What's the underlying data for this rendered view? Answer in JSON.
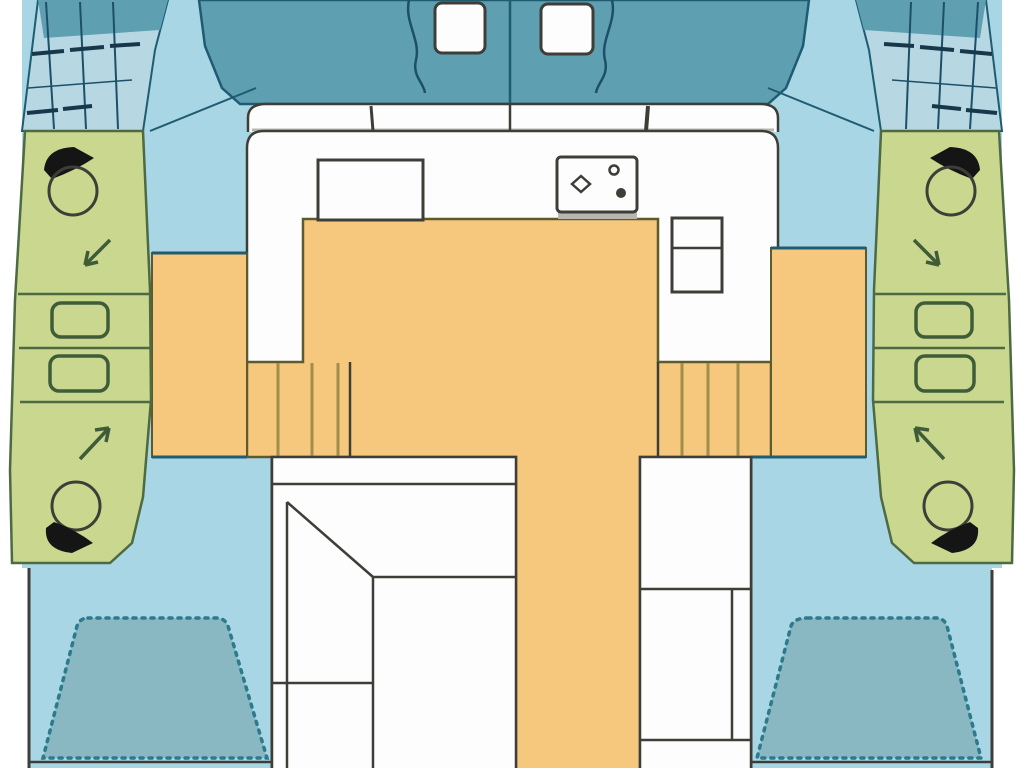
{
  "meta": {
    "title": "catamaran-deck-floorplan",
    "width": 1024,
    "height": 768
  },
  "colors": {
    "page": "#ffffff",
    "deck": "#a9d6e5",
    "hull": "#5f9fb2",
    "net": "#b7d8e3",
    "netline": "#1d5068",
    "tealline": "#1f5c72",
    "beddark": "#16384a",
    "bedfill": "#8ab8c2",
    "bedstroke": "#2d7a8c",
    "green": "#c9d88e",
    "greenline": "#4e6a43",
    "sinkline": "#3f5c39",
    "orange": "#f6c87e",
    "olive": "#5d5a2e",
    "step": "#a08e4a",
    "white": "#fdfdfd",
    "dark": "#3e3e38",
    "black": "#151515",
    "gray": "#b9b6b0"
  },
  "shapes": [
    {
      "n": "deck",
      "k": "polygon",
      "p": "22,0 1002,0 1002,568 992,568 992,772 29,772 29,568 22,568",
      "f": "deck"
    },
    {
      "n": "bow-left-net-area",
      "k": "polygon",
      "p": "38,0 168,0 155,50 143,131 22,131",
      "f": "net",
      "s": "tealline",
      "sw": 2
    },
    {
      "n": "bow-left-cap",
      "k": "polygon",
      "p": "38,0 168,0 160,30 44,38",
      "f": "hull"
    },
    {
      "n": "bow-left-net-line-1",
      "k": "line",
      "x1": 46,
      "y1": 2,
      "x2": 54,
      "y2": 129,
      "s": "netline",
      "sw": 2
    },
    {
      "n": "bow-left-net-line-2",
      "k": "line",
      "x1": 80,
      "y1": 2,
      "x2": 86,
      "y2": 129,
      "s": "netline",
      "sw": 2
    },
    {
      "n": "bow-left-net-line-3",
      "k": "line",
      "x1": 113,
      "y1": 2,
      "x2": 118,
      "y2": 129,
      "s": "netline",
      "sw": 2
    },
    {
      "n": "bow-left-net-line-4",
      "k": "line",
      "x1": 28,
      "y1": 88,
      "x2": 132,
      "y2": 80,
      "s": "netline",
      "sw": 1.5
    },
    {
      "n": "bow-left-windlass",
      "k": "path",
      "d": "M32,54 L64,51 M70,50 L104,47 M110,46 L140,44 M27,113 L58,110 M63,109 L92,106",
      "s": "beddark",
      "sw": 4
    },
    {
      "n": "bow-right-net-area",
      "k": "polygon",
      "p": "986,0 856,0 869,50 881,131 1002,131",
      "f": "net",
      "s": "tealline",
      "sw": 2
    },
    {
      "n": "bow-right-cap",
      "k": "polygon",
      "p": "986,0 856,0 864,30 980,38",
      "f": "hull"
    },
    {
      "n": "bow-right-net-line-1",
      "k": "line",
      "x1": 978,
      "y1": 2,
      "x2": 970,
      "y2": 129,
      "s": "netline",
      "sw": 2
    },
    {
      "n": "bow-right-net-line-2",
      "k": "line",
      "x1": 944,
      "y1": 2,
      "x2": 938,
      "y2": 129,
      "s": "netline",
      "sw": 2
    },
    {
      "n": "bow-right-net-line-3",
      "k": "line",
      "x1": 911,
      "y1": 2,
      "x2": 906,
      "y2": 129,
      "s": "netline",
      "sw": 2
    },
    {
      "n": "bow-right-net-line-4",
      "k": "line",
      "x1": 996,
      "y1": 88,
      "x2": 892,
      "y2": 80,
      "s": "netline",
      "sw": 1.5
    },
    {
      "n": "bow-right-windlass",
      "k": "path",
      "d": "M992,54 L960,51 M954,50 L920,47 M914,46 L884,44 M997,113 L966,110 M961,109 L932,106",
      "s": "beddark",
      "sw": 4
    },
    {
      "n": "forward-cockpit",
      "k": "polygon",
      "p": "199,0 809,0 803,46 786,88 768,104 240,104 222,88 205,46",
      "f": "hull",
      "s": "tealline",
      "sw": 2.5
    },
    {
      "n": "cockpit-center-line",
      "k": "line",
      "x1": 510,
      "y1": 0,
      "x2": 510,
      "y2": 104,
      "s": "tealline",
      "sw": 2.5
    },
    {
      "n": "rope-left",
      "k": "path",
      "d": "M409,0 C404,22 421,40 416,60 C412,76 424,83 425,93",
      "s": "netline",
      "sw": 2.5
    },
    {
      "n": "rope-right",
      "k": "path",
      "d": "M612,0 C617,22 600,40 605,60 C609,76 597,83 596,93",
      "s": "netline",
      "sw": 2.5
    },
    {
      "n": "hatch-left",
      "k": "rect",
      "x": 435,
      "y": 3,
      "w": 50,
      "h": 50,
      "rx": 7,
      "f": "white",
      "s": "dark",
      "sw": 3
    },
    {
      "n": "hatch-right",
      "k": "rect",
      "x": 541,
      "y": 4,
      "w": 52,
      "h": 50,
      "rx": 7,
      "f": "white",
      "s": "dark",
      "sw": 3
    },
    {
      "n": "deck-seam-left",
      "k": "line",
      "x1": 256,
      "y1": 88,
      "x2": 150,
      "y2": 131,
      "s": "tealline",
      "sw": 2
    },
    {
      "n": "deck-seam-right",
      "k": "line",
      "x1": 768,
      "y1": 88,
      "x2": 874,
      "y2": 131,
      "s": "tealline",
      "sw": 2
    },
    {
      "n": "coachroof-band",
      "k": "path",
      "d": "M248,132 L248,118 Q248,104 266,104 L760,104 Q778,104 778,118 L778,132",
      "f": "white",
      "s": "dark",
      "sw": 2.5
    },
    {
      "n": "coachroof-band-shadow",
      "k": "line",
      "x1": 252,
      "y1": 130,
      "x2": 774,
      "y2": 130,
      "s": "gray",
      "sw": 3
    },
    {
      "n": "band-tick-left",
      "k": "line",
      "x1": 371,
      "y1": 106,
      "x2": 373,
      "y2": 131,
      "s": "dark",
      "sw": 3
    },
    {
      "n": "band-tick-center",
      "k": "line",
      "x1": 510,
      "y1": 104,
      "x2": 510,
      "y2": 131,
      "s": "dark",
      "sw": 2.5
    },
    {
      "n": "band-tick-right",
      "k": "line",
      "x1": 648,
      "y1": 106,
      "x2": 646,
      "y2": 131,
      "s": "dark",
      "sw": 4
    },
    {
      "n": "cabin-body",
      "k": "path",
      "d": "M247,457 L247,148 Q247,131 264,131 L761,131 Q778,131 778,148 L778,457",
      "f": "white",
      "s": "dark",
      "sw": 2.5
    },
    {
      "n": "salon-floor",
      "k": "polygon",
      "p": "303,219 658,219 658,362 771,362 771,457 640,457 640,772 516,772 516,457 247,457 247,362 303,362",
      "f": "orange",
      "s": "olive",
      "sw": 2.5
    },
    {
      "n": "hull-corridor-left",
      "k": "rect",
      "x": 152,
      "y": 253,
      "w": 95,
      "h": 204,
      "f": "orange",
      "s": "olive",
      "sw": 2
    },
    {
      "n": "hull-corridor-right",
      "k": "rect",
      "x": 771,
      "y": 248,
      "w": 95,
      "h": 209,
      "f": "orange",
      "s": "olive",
      "sw": 2
    },
    {
      "n": "corridor-edge-left",
      "k": "line",
      "x1": 152,
      "y1": 253,
      "x2": 247,
      "y2": 253,
      "s": "tealline",
      "sw": 3
    },
    {
      "n": "corridor-edge-right",
      "k": "line",
      "x1": 771,
      "y1": 248,
      "x2": 866,
      "y2": 248,
      "s": "tealline",
      "sw": 3
    },
    {
      "n": "steps-left",
      "k": "path",
      "d": "M278,363 L278,456 M312,363 L312,456 M338,363 L338,456",
      "s": "step",
      "sw": 3
    },
    {
      "n": "steps-left-edge",
      "k": "line",
      "x1": 350,
      "y1": 362,
      "x2": 350,
      "y2": 457,
      "s": "dark",
      "sw": 2.5
    },
    {
      "n": "steps-right",
      "k": "path",
      "d": "M682,363 L682,456 M708,363 L708,456 M738,363 L738,456",
      "s": "step",
      "sw": 3
    },
    {
      "n": "steps-right-edge",
      "k": "line",
      "x1": 658,
      "y1": 362,
      "x2": 658,
      "y2": 457,
      "s": "dark",
      "sw": 2.5
    },
    {
      "n": "deck-break-left",
      "k": "line",
      "x1": 152,
      "y1": 457,
      "x2": 247,
      "y2": 457,
      "s": "tealline",
      "sw": 3
    },
    {
      "n": "deck-break-right",
      "k": "line",
      "x1": 751,
      "y1": 457,
      "x2": 866,
      "y2": 457,
      "s": "tealline",
      "sw": 3
    },
    {
      "n": "transom-left",
      "k": "line",
      "x1": 29,
      "y1": 762,
      "x2": 272,
      "y2": 762,
      "s": "dark",
      "sw": 2.5
    },
    {
      "n": "transom-right",
      "k": "line",
      "x1": 751,
      "y1": 762,
      "x2": 992,
      "y2": 762,
      "s": "dark",
      "sw": 2.5
    },
    {
      "n": "bed-left",
      "k": "path",
      "d": "M88,618 L216,618 Q225,618 228,626 L267,758 L43,758 L77,626 Q80,618 88,618 Z",
      "f": "bedfill",
      "s": "bedstroke",
      "sw": 3.5,
      "da": "3 6",
      "lc": "round"
    },
    {
      "n": "bed-right",
      "k": "path",
      "d": "M808,618 L936,618 Q944,618 947,626 L981,758 L757,758 L791,626 Q794,618 808,618 Z",
      "f": "bedfill",
      "s": "bedstroke",
      "sw": 3.5,
      "da": "3 6",
      "lc": "round"
    },
    {
      "n": "hull-wall-left",
      "k": "line",
      "x1": 29,
      "y1": 568,
      "x2": 29,
      "y2": 772,
      "s": "dark",
      "sw": 3
    },
    {
      "n": "hull-wall-right",
      "k": "line",
      "x1": 992,
      "y1": 570,
      "x2": 992,
      "y2": 772,
      "s": "dark",
      "sw": 3
    },
    {
      "n": "cabin-wall-left",
      "k": "line",
      "x1": 272,
      "y1": 457,
      "x2": 272,
      "y2": 772,
      "s": "dark",
      "sw": 3
    },
    {
      "n": "cabin-wall-right",
      "k": "line",
      "x1": 751,
      "y1": 457,
      "x2": 751,
      "y2": 772,
      "s": "dark",
      "sw": 3
    },
    {
      "n": "dinette-area",
      "k": "rect",
      "x": 272,
      "y": 457,
      "w": 244,
      "h": 316,
      "f": "white",
      "s": "dark",
      "sw": 2.5
    },
    {
      "n": "dinette-seatback",
      "k": "line",
      "x1": 272,
      "y1": 484,
      "x2": 516,
      "y2": 484,
      "s": "dark",
      "sw": 2.5
    },
    {
      "n": "dinette-bench-diagonal",
      "k": "line",
      "x1": 287,
      "y1": 502,
      "x2": 373,
      "y2": 577,
      "s": "dark",
      "sw": 2.5
    },
    {
      "n": "dinette-table-top",
      "k": "line",
      "x1": 373,
      "y1": 577,
      "x2": 516,
      "y2": 577,
      "s": "dark",
      "sw": 2.5
    },
    {
      "n": "dinette-table-side",
      "k": "line",
      "x1": 373,
      "y1": 577,
      "x2": 373,
      "y2": 772,
      "s": "dark",
      "sw": 2.5
    },
    {
      "n": "dinette-bench-side",
      "k": "line",
      "x1": 287,
      "y1": 502,
      "x2": 287,
      "y2": 772,
      "s": "dark",
      "sw": 2.5
    },
    {
      "n": "dinette-bench-seat",
      "k": "line",
      "x1": 272,
      "y1": 683,
      "x2": 373,
      "y2": 683,
      "s": "dark",
      "sw": 2.5
    },
    {
      "n": "aft-seat-area",
      "k": "rect",
      "x": 640,
      "y": 457,
      "w": 111,
      "h": 316,
      "f": "white",
      "s": "dark",
      "sw": 2.5
    },
    {
      "n": "aft-seat-line-1",
      "k": "line",
      "x1": 640,
      "y1": 589,
      "x2": 751,
      "y2": 589,
      "s": "dark",
      "sw": 2.5
    },
    {
      "n": "aft-seat-line-2",
      "k": "line",
      "x1": 640,
      "y1": 740,
      "x2": 751,
      "y2": 740,
      "s": "dark",
      "sw": 2.5
    },
    {
      "n": "aft-seat-divider",
      "k": "line",
      "x1": 732,
      "y1": 589,
      "x2": 732,
      "y2": 740,
      "s": "dark",
      "sw": 2.5
    },
    {
      "n": "head-left",
      "k": "polygon",
      "p": "25,131 143,131 150,290 151,400 143,497 132,543 110,563 12,563 10,470 15,300",
      "f": "green",
      "s": "greenline",
      "sw": 2.5
    },
    {
      "n": "head-left-divider-1",
      "k": "line",
      "x1": 18,
      "y1": 294,
      "x2": 150,
      "y2": 294,
      "s": "greenline",
      "sw": 2.5
    },
    {
      "n": "head-left-divider-2",
      "k": "line",
      "x1": 19,
      "y1": 348,
      "x2": 151,
      "y2": 348,
      "s": "greenline",
      "sw": 2.5
    },
    {
      "n": "head-left-divider-3",
      "k": "line",
      "x1": 20,
      "y1": 402,
      "x2": 150,
      "y2": 402,
      "s": "greenline",
      "sw": 2.5
    },
    {
      "n": "sink-left-1",
      "k": "rect",
      "x": 52,
      "y": 303,
      "w": 56,
      "h": 34,
      "rx": 9,
      "s": "sinkline",
      "sw": 3.5
    },
    {
      "n": "sink-left-2",
      "k": "rect",
      "x": 50,
      "y": 356,
      "w": 58,
      "h": 35,
      "rx": 9,
      "s": "sinkline",
      "sw": 3.5
    },
    {
      "n": "toilet-left-fwd-tank",
      "k": "path",
      "d": "M44,170 Q46,148 74,147 L94,158 Q76,170 52,179 Z",
      "f": "black"
    },
    {
      "n": "toilet-left-fwd-bowl",
      "k": "circle",
      "cx": 73,
      "cy": 191,
      "r": 24,
      "s": "dark",
      "sw": 3
    },
    {
      "n": "shower-arrow-left-fwd",
      "k": "path",
      "d": "M110,240 L85,265 M85,265 L98,262 M85,265 L88,251",
      "s": "sinkline",
      "sw": 3.5
    },
    {
      "n": "shower-arrow-left-aft",
      "k": "path",
      "d": "M80,459 L109,428 M109,428 L95,430 M109,428 L106,442",
      "s": "sinkline",
      "sw": 3.5
    },
    {
      "n": "toilet-left-aft-bowl",
      "k": "circle",
      "cx": 76,
      "cy": 506,
      "r": 24,
      "s": "dark",
      "sw": 3
    },
    {
      "n": "toilet-left-aft-tank",
      "k": "path",
      "d": "M46,528 Q44,550 72,553 L93,543 Q76,530 54,522 Z",
      "f": "black"
    },
    {
      "n": "head-right",
      "k": "polygon",
      "p": "999,131 881,131 874,290 873,400 881,497 892,543 914,563 1012,563 1014,470 1009,300",
      "f": "green",
      "s": "greenline",
      "sw": 2.5
    },
    {
      "n": "head-right-divider-1",
      "k": "line",
      "x1": 874,
      "y1": 294,
      "x2": 1006,
      "y2": 294,
      "s": "greenline",
      "sw": 2.5
    },
    {
      "n": "head-right-divider-2",
      "k": "line",
      "x1": 873,
      "y1": 348,
      "x2": 1005,
      "y2": 348,
      "s": "greenline",
      "sw": 2.5
    },
    {
      "n": "head-right-divider-3",
      "k": "line",
      "x1": 874,
      "y1": 402,
      "x2": 1004,
      "y2": 402,
      "s": "greenline",
      "sw": 2.5
    },
    {
      "n": "sink-right-1",
      "k": "rect",
      "x": 916,
      "y": 303,
      "w": 56,
      "h": 34,
      "rx": 9,
      "s": "sinkline",
      "sw": 3.5
    },
    {
      "n": "sink-right-2",
      "k": "rect",
      "x": 916,
      "y": 356,
      "w": 58,
      "h": 35,
      "rx": 9,
      "s": "sinkline",
      "sw": 3.5
    },
    {
      "n": "toilet-right-fwd-tank",
      "k": "path",
      "d": "M980,170 Q978,148 950,147 L930,158 Q948,170 972,179 Z",
      "f": "black"
    },
    {
      "n": "toilet-right-fwd-bowl",
      "k": "circle",
      "cx": 951,
      "cy": 191,
      "r": 24,
      "s": "dark",
      "sw": 3
    },
    {
      "n": "shower-arrow-right-fwd",
      "k": "path",
      "d": "M914,240 L939,265 M939,265 L926,262 M939,265 L936,251",
      "s": "sinkline",
      "sw": 3.5
    },
    {
      "n": "shower-arrow-right-aft",
      "k": "path",
      "d": "M944,459 L915,428 M915,428 L929,430 M915,428 L918,442",
      "s": "sinkline",
      "sw": 3.5
    },
    {
      "n": "toilet-right-aft-bowl",
      "k": "circle",
      "cx": 948,
      "cy": 506,
      "r": 24,
      "s": "dark",
      "sw": 3
    },
    {
      "n": "toilet-right-aft-tank",
      "k": "path",
      "d": "M978,528 Q980,550 952,553 L931,543 Q948,530 970,522 Z",
      "f": "black"
    },
    {
      "n": "galley-counter",
      "k": "rect",
      "x": 318,
      "y": 160,
      "w": 105,
      "h": 60,
      "f": "white",
      "s": "dark",
      "sw": 3
    },
    {
      "n": "stove-shadow",
      "k": "rect",
      "x": 558,
      "y": 212,
      "w": 79,
      "h": 7,
      "f": "gray"
    },
    {
      "n": "stove",
      "k": "rect",
      "x": 557,
      "y": 157,
      "w": 80,
      "h": 55,
      "rx": 4,
      "f": "white",
      "s": "dark",
      "sw": 3
    },
    {
      "n": "stove-burner-diamond",
      "k": "path",
      "d": "M572,184 L581,176 L590,184 L581,192 Z",
      "s": "dark",
      "sw": 2.5
    },
    {
      "n": "stove-burner-small",
      "k": "circle",
      "cx": 614,
      "cy": 170,
      "r": 4.5,
      "s": "dark",
      "sw": 2.5
    },
    {
      "n": "stove-burner-knob",
      "k": "circle",
      "cx": 621,
      "cy": 193,
      "r": 5,
      "f": "dark"
    },
    {
      "n": "fridge",
      "k": "rect",
      "x": 672,
      "y": 218,
      "w": 50,
      "h": 74,
      "f": "white",
      "s": "dark",
      "sw": 3
    },
    {
      "n": "fridge-divider",
      "k": "line",
      "x1": 672,
      "y1": 248,
      "x2": 722,
      "y2": 248,
      "s": "dark",
      "sw": 2.5
    }
  ]
}
